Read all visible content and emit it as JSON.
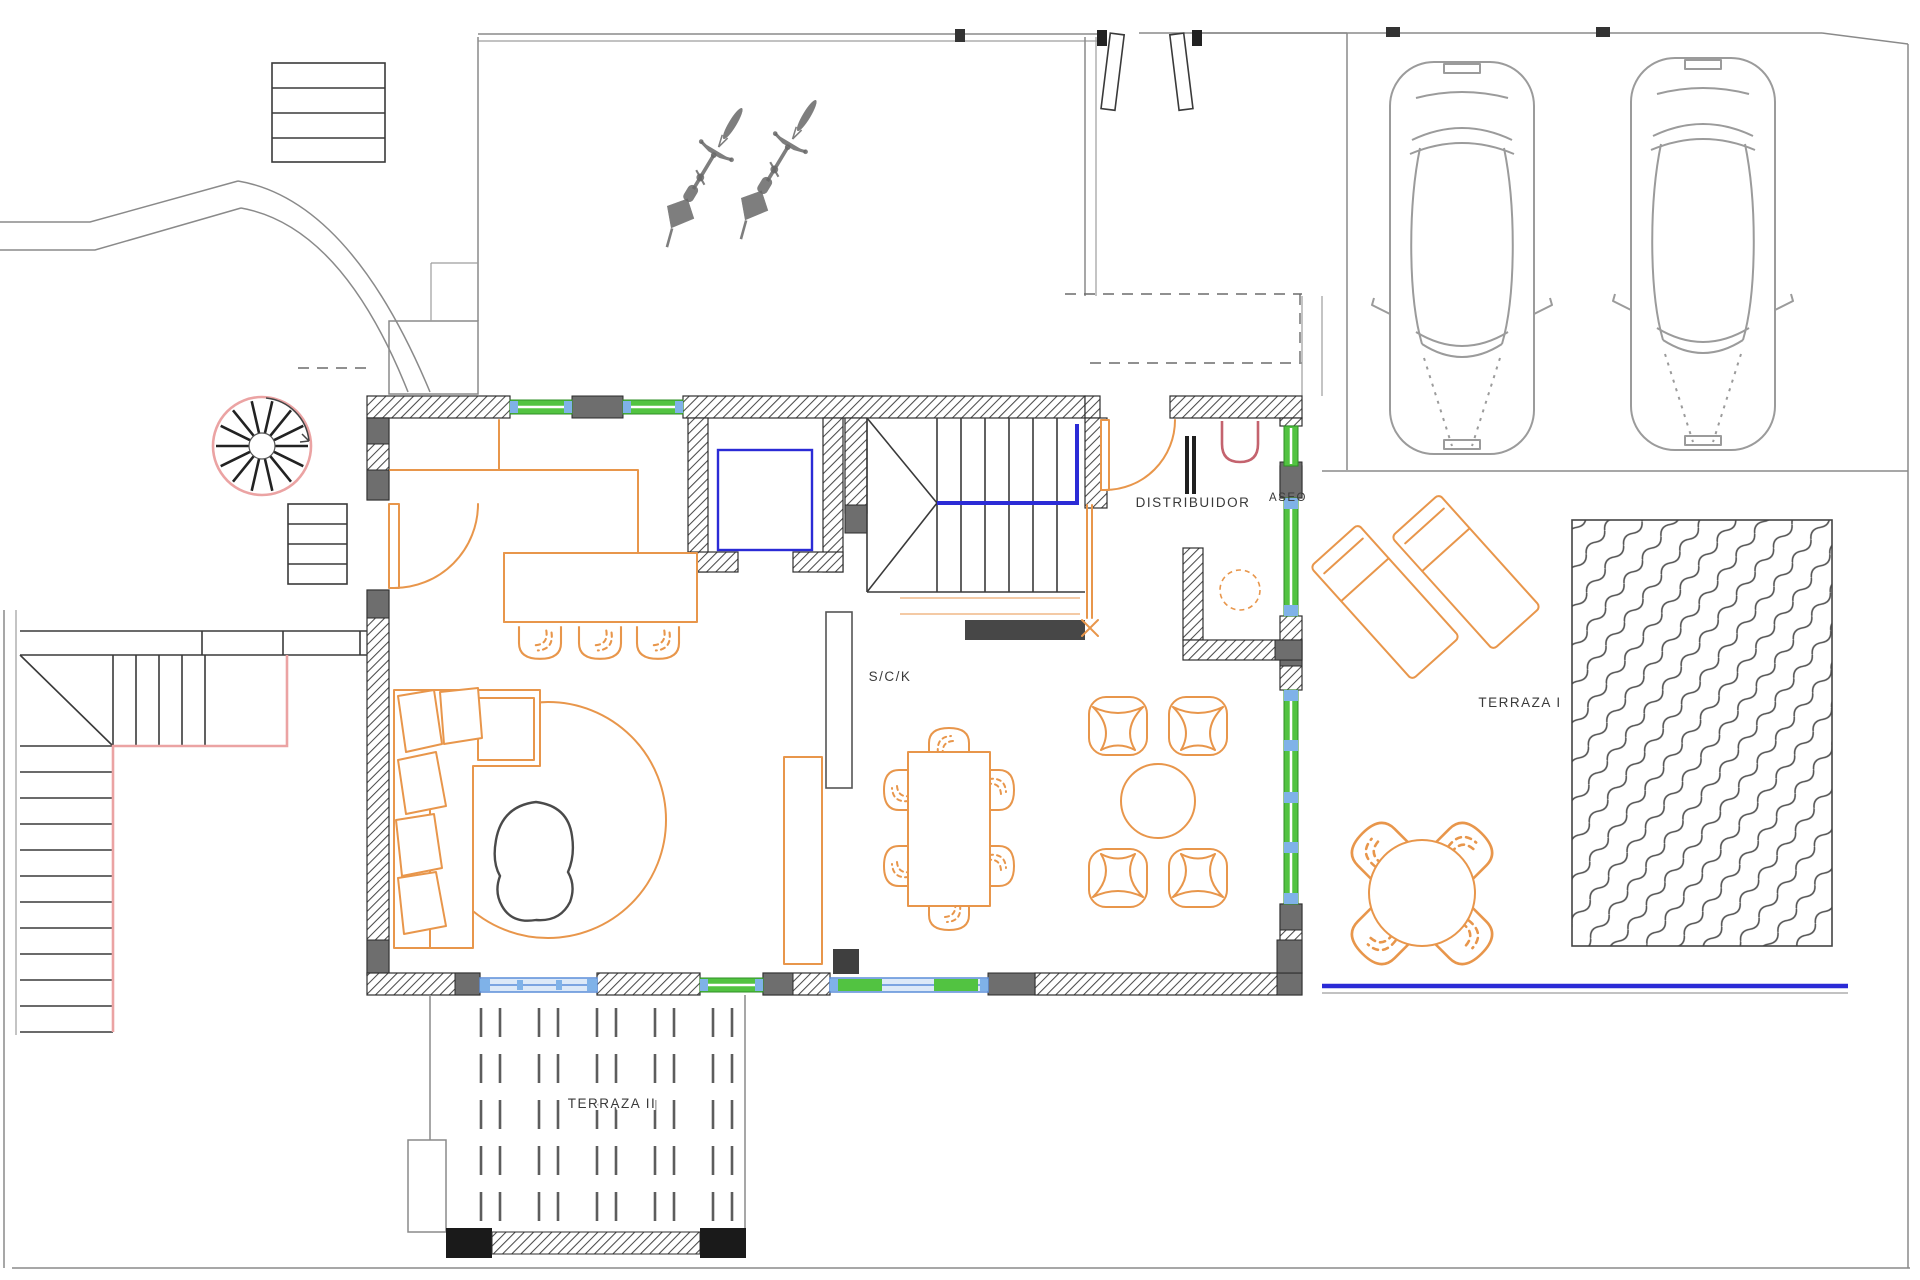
{
  "labels": {
    "room_main": "S/C/K",
    "hall": "DISTRIBUIDOR",
    "toilet": "ASEO",
    "terrace1": "TERRAZA I",
    "terrace2": "TERRAZA II"
  },
  "colors": {
    "furniture_orange": "#e8964b",
    "stair_pink": "#eba3a3",
    "sink_red": "#c4636e",
    "accent_blue": "#2b2bd6",
    "glass_blue": "#7fb2e8",
    "glass_blue_light": "#dce9f8",
    "window_green": "#52c341",
    "wall_hatch": "#4a4a4a",
    "pillar_gray": "#6e6e6e",
    "car_gray": "#9b9b9b",
    "bike_gray": "#686868",
    "line_gray": "#8a8a8a",
    "dark_line": "#3a3a3a"
  }
}
